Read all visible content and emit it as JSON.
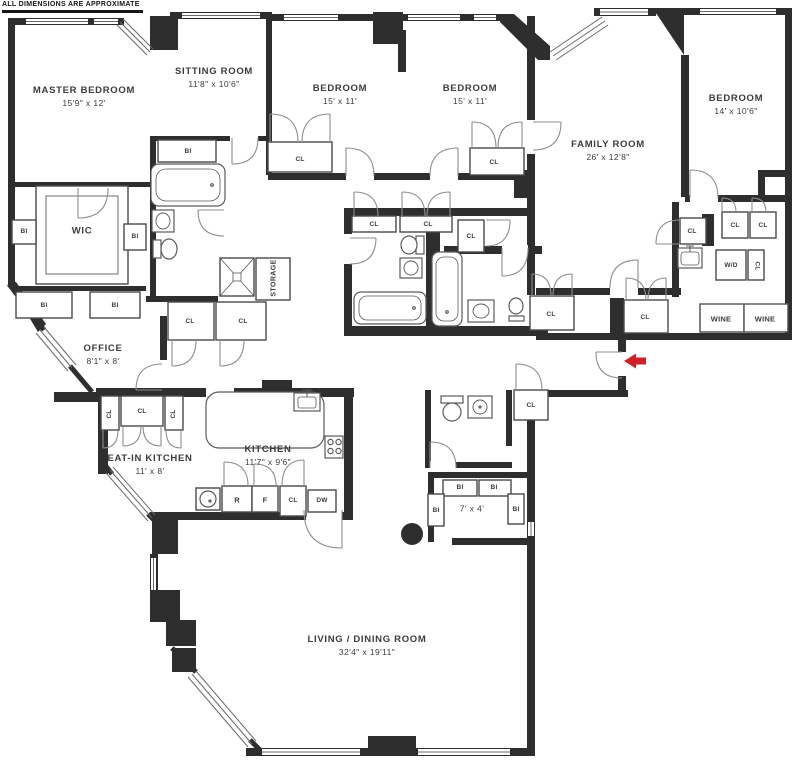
{
  "colors": {
    "wall": "#2e2e2e",
    "partition": "#4a4a4a",
    "door_arc": "#8e8e8e",
    "fixture": "#5a5a5a",
    "window_line": "#6a6a6a",
    "accent_red": "#ce2127",
    "text": "#3c3c3c"
  },
  "disclaimer": "ALL DIMENSIONS ARE APPROXIMATE",
  "rooms": {
    "master_bedroom": {
      "name": "MASTER BEDROOM",
      "dims": "15'9\" x 12'"
    },
    "sitting_room": {
      "name": "SITTING ROOM",
      "dims": "11'8\" x 10'6\""
    },
    "bedroom_2": {
      "name": "BEDROOM",
      "dims": "15' x 11'"
    },
    "bedroom_3": {
      "name": "BEDROOM",
      "dims": "15' x 11'"
    },
    "family_room": {
      "name": "FAMILY ROOM",
      "dims": "26' x 12'8\""
    },
    "bedroom_4": {
      "name": "BEDROOM",
      "dims": "14' x 10'6\""
    },
    "wic": {
      "name": "WIC"
    },
    "office": {
      "name": "OFFICE",
      "dims": "8'1\" x 8'"
    },
    "eat_in_kitchen": {
      "name": "EAT-IN KITCHEN",
      "dims": "11' x 8'"
    },
    "kitchen": {
      "name": "KITCHEN",
      "dims": "11'7\" x 9'6\""
    },
    "storage": {
      "name": "STORAGE"
    },
    "utility_room": {
      "dims": "7' x 4'"
    },
    "living_dining": {
      "name": "LIVING / DINING ROOM",
      "dims": "32'4\" x 19'11\""
    }
  },
  "labels": {
    "closet": "CL",
    "built_in": "BI",
    "washer_dryer": "W/D",
    "wine": "WINE",
    "refrigerator": "R",
    "freezer": "F",
    "dishwasher": "DW"
  }
}
